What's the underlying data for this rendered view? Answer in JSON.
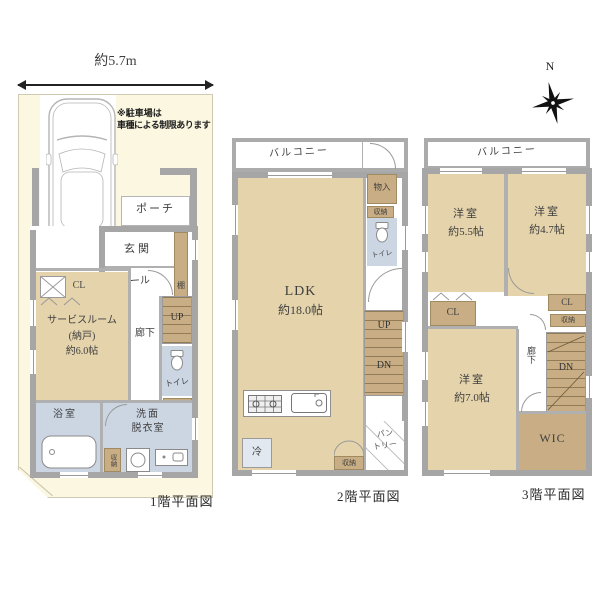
{
  "colors": {
    "room_beige": "#e4d3ab",
    "wood_brown": "#c9ae85",
    "wet_blue": "#ccd6e3",
    "wall_gray": "#a6a6a6",
    "lot_cream": "#fbf7e1"
  },
  "site": {
    "width_label": "約5.7m",
    "note1": "※駐車場は",
    "note2": "車種による制限あります",
    "compass_n": "N"
  },
  "floor1": {
    "caption": "1階平面図",
    "porch": "ポーチ",
    "entrance": "玄関",
    "hall": "ホール",
    "shelf": "棚",
    "closet": "CL",
    "corridor": "廊下",
    "up": "UP",
    "toilet": "トイレ",
    "storage_a": "収納",
    "storage_b": "収納",
    "service_room": [
      "サービスルーム",
      "(納戸)",
      "約6.0帖"
    ],
    "bath": "浴室",
    "washroom": [
      "洗面",
      "脱衣室"
    ]
  },
  "floor2": {
    "caption": "2階平面図",
    "balcony": "バルコニー",
    "closet_top": "物入",
    "storage_a": "収納",
    "toilet": "トイレ",
    "ldk": [
      "LDK",
      "約18.0帖"
    ],
    "up": "UP",
    "dn": "DN",
    "fridge": "冷",
    "storage_b": "収納",
    "pantry": [
      "パン",
      "トリー"
    ]
  },
  "floor3": {
    "caption": "3階平面図",
    "balcony": "バルコニー",
    "room_a": [
      "洋室",
      "約5.5帖"
    ],
    "room_b": [
      "洋室",
      "約4.7帖"
    ],
    "room_c": [
      "洋室",
      "約7.0帖"
    ],
    "closet_a": "CL",
    "closet_b": "CL",
    "storage": "収納",
    "corridor": "廊下",
    "dn": "DN",
    "wic": "WIC"
  }
}
